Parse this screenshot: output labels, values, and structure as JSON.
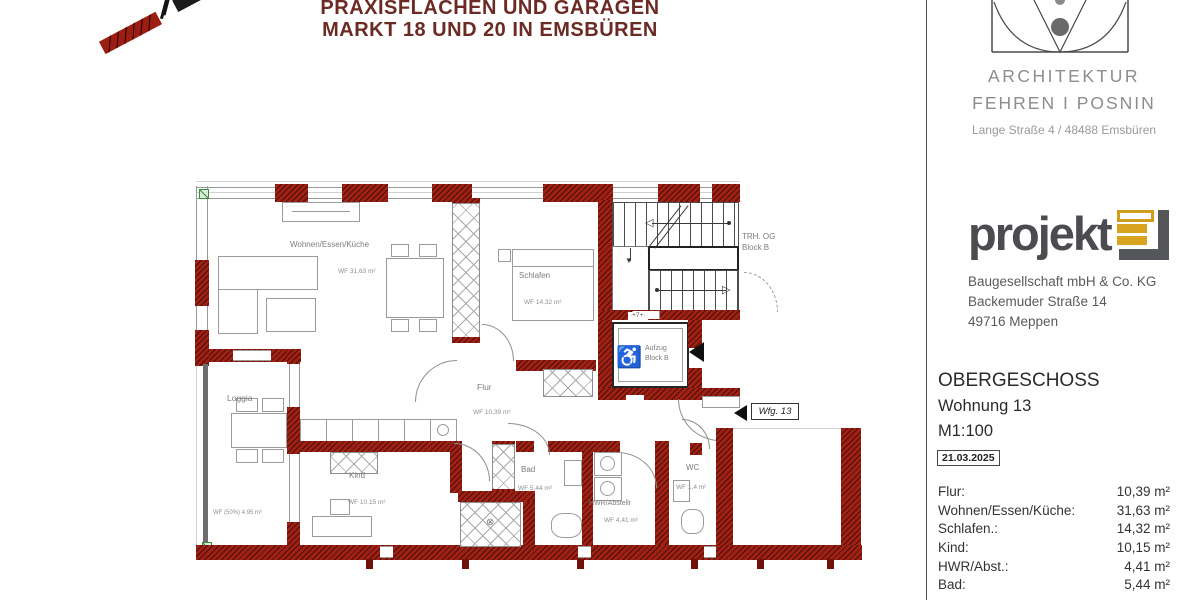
{
  "title": {
    "line1": "PRAXISFLÄCHEN UND GARAGEN",
    "line2": "MARKT 18 UND 20 IN EMSBÜREN"
  },
  "architect": {
    "line1": "ARCHITEKTUR",
    "line2": "FEHREN I POSNIN",
    "address": "Lange Straße 4 / 48488 Emsbüren"
  },
  "developer": {
    "logo": "projekt",
    "line1": "Baugesellschaft mbH & Co. KG",
    "line2": "Backemuder Straße 14",
    "line3": "49716 Meppen"
  },
  "sheet": {
    "floor": "OBERGESCHOSS",
    "unit": "Wohnung 13",
    "scale": "M1:100",
    "date": "21.03.2025"
  },
  "areas": [
    {
      "label": "Flur:",
      "value": "10,39 m²"
    },
    {
      "label": "Wohnen/Essen/Küche:",
      "value": "31,63 m²"
    },
    {
      "label": "Schlafen.:",
      "value": "14,32 m²"
    },
    {
      "label": "Kind:",
      "value": "10,15 m²"
    },
    {
      "label": "HWR/Abst.:",
      "value": "4,41 m²"
    },
    {
      "label": "Bad:",
      "value": "5,44 m²"
    }
  ],
  "plan": {
    "rooms": {
      "wohnen": {
        "name": "Wohnen/Essen/Küche",
        "area": "WF 31,63 m²"
      },
      "schlafen": {
        "name": "Schlafen",
        "area": "WF 14,32 m²"
      },
      "flur": {
        "name": "Flur",
        "area": "WF 10,39 m²"
      },
      "kind": {
        "name": "Kind",
        "area": "WF 10,15 m²"
      },
      "bad": {
        "name": "Bad",
        "area": "WF 5,44 m²"
      },
      "hwr": {
        "name": "HWR/Abstellr",
        "area": "WF 4,41 m²"
      },
      "wc": {
        "name": "WC",
        "area": "WF 1,4 m²"
      },
      "loggia": {
        "name": "Loggia",
        "area": "WF (50%) 4,95 m²"
      }
    },
    "stairwell": {
      "line1": "TRH. OG",
      "line2": "Block B"
    },
    "elevator": {
      "line1": "Aufzug",
      "line2": "Block B",
      "dim": "·+7+·"
    },
    "entry_tag": "Wfg. 13"
  }
}
